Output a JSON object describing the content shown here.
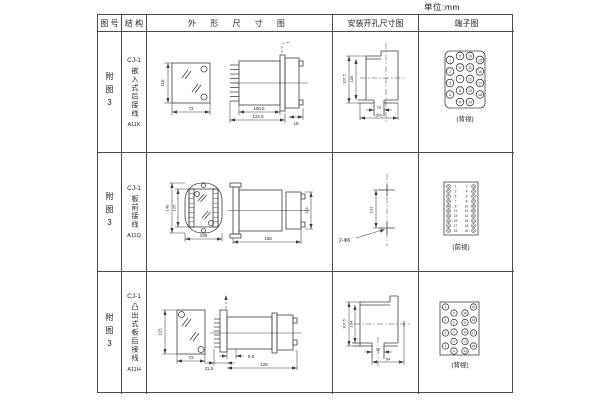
{
  "unit_label": "单位:mm",
  "header": {
    "fig_no": "图 号",
    "structure": "结 构",
    "outline": "外 形 尺 寸 图",
    "mounting": "安装开孔尺寸图",
    "terminal": "端子图"
  },
  "rows": [
    {
      "fig_no": "附图3",
      "model": "CJ-1",
      "structure": "嵌入式后接线",
      "code": "A11K",
      "outline": {
        "front_height": "115",
        "front_width": "72",
        "body_length": "100.5",
        "overall_length": "122.5",
        "tail_length": "15"
      },
      "mounting": {
        "outer_height": "107.5",
        "inner_height": "105",
        "slot_width": "16",
        "overall_width": "(64)"
      },
      "terminal_label": "(背视)"
    },
    {
      "fig_no": "附图3",
      "model": "CJ-1",
      "structure": "板前接线",
      "code": "A11Q",
      "outline": {
        "front_height_outer": "140",
        "front_height_inner": "125",
        "front_width": "105",
        "side_length": "156",
        "side_height": "115"
      },
      "mounting": {
        "hole_distance": "131",
        "hole_note": "2-Φ6"
      },
      "terminal_label": "(前视)"
    },
    {
      "fig_no": "附图3",
      "model": "CJ-1",
      "structure": "凸出式板后接线",
      "code": "A11H",
      "outline": {
        "front_height": "115",
        "front_width": "72",
        "pin_length": "31.5",
        "step_length": "9.5",
        "overall_length": "126"
      },
      "mounting": {
        "outer_height": "107.5",
        "inner_height": "104",
        "slot_width": "16",
        "overall_width": "64"
      },
      "terminal_label": "(背视)"
    }
  ],
  "terminals": {
    "rear": [
      "1",
      "2",
      "3",
      "4",
      "5",
      "6",
      "7",
      "8",
      "9",
      "10",
      "11",
      "12",
      "13",
      "14",
      "15",
      "16",
      "17",
      "18"
    ],
    "front_left": [
      "1",
      "3",
      "5",
      "7",
      "9",
      "11",
      "13",
      "15",
      "17",
      "19"
    ],
    "front_right": [
      "2",
      "4",
      "6",
      "8",
      "10",
      "12",
      "14",
      "16",
      "18",
      "20"
    ]
  }
}
